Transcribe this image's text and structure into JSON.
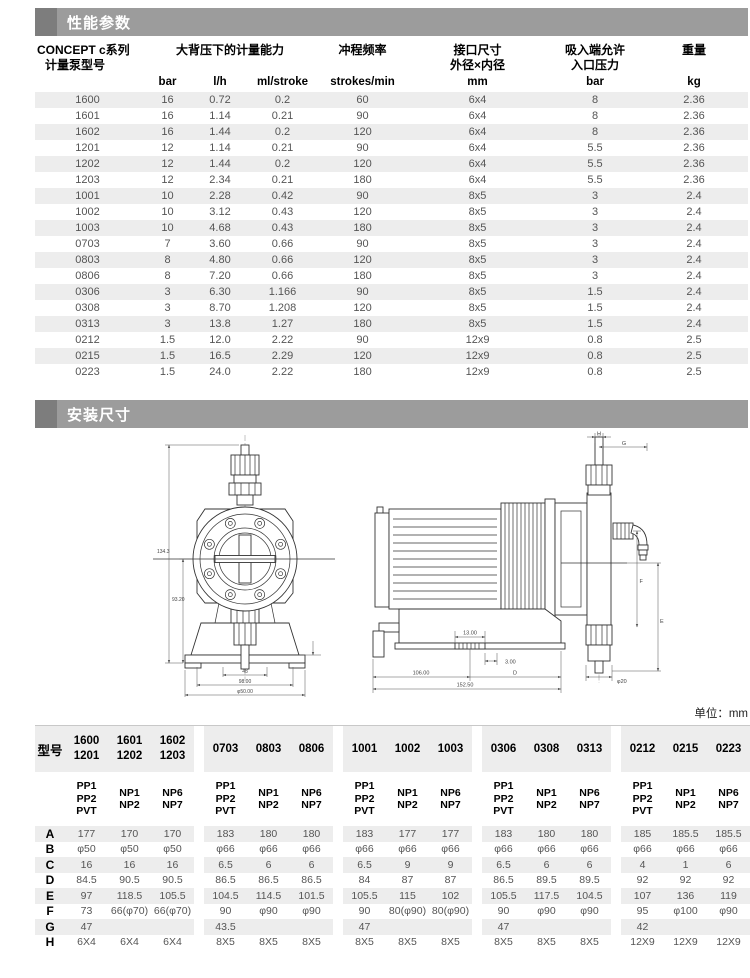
{
  "section1": {
    "title": "性能参数"
  },
  "perf_table": {
    "headers": {
      "model_line1": "CONCEPT c系列",
      "model_line2": "计量泵型号",
      "capacity": "大背压下的计量能力",
      "freq": "冲程频率",
      "port_line1": "接口尺寸",
      "port_line2": "外径×内径",
      "suction_line1": "吸入端允许",
      "suction_line2": "入口压力",
      "weight": "重量",
      "units": [
        "bar",
        "l/h",
        "ml/stroke",
        "strokes/min",
        "mm",
        "bar",
        "kg"
      ]
    },
    "rows": [
      [
        "1600",
        "16",
        "0.72",
        "0.2",
        "60",
        "6x4",
        "8",
        "2.36"
      ],
      [
        "1601",
        "16",
        "1.14",
        "0.21",
        "90",
        "6x4",
        "8",
        "2.36"
      ],
      [
        "1602",
        "16",
        "1.44",
        "0.2",
        "120",
        "6x4",
        "8",
        "2.36"
      ],
      [
        "1201",
        "12",
        "1.14",
        "0.21",
        "90",
        "6x4",
        "5.5",
        "2.36"
      ],
      [
        "1202",
        "12",
        "1.44",
        "0.2",
        "120",
        "6x4",
        "5.5",
        "2.36"
      ],
      [
        "1203",
        "12",
        "2.34",
        "0.21",
        "180",
        "6x4",
        "5.5",
        "2.36"
      ],
      [
        "1001",
        "10",
        "2.28",
        "0.42",
        "90",
        "8x5",
        "3",
        "2.4"
      ],
      [
        "1002",
        "10",
        "3.12",
        "0.43",
        "120",
        "8x5",
        "3",
        "2.4"
      ],
      [
        "1003",
        "10",
        "4.68",
        "0.43",
        "180",
        "8x5",
        "3",
        "2.4"
      ],
      [
        "0703",
        "7",
        "3.60",
        "0.66",
        "90",
        "8x5",
        "3",
        "2.4"
      ],
      [
        "0803",
        "8",
        "4.80",
        "0.66",
        "120",
        "8x5",
        "3",
        "2.4"
      ],
      [
        "0806",
        "8",
        "7.20",
        "0.66",
        "180",
        "8x5",
        "3",
        "2.4"
      ],
      [
        "0306",
        "3",
        "6.30",
        "1.166",
        "90",
        "8x5",
        "1.5",
        "2.4"
      ],
      [
        "0308",
        "3",
        "8.70",
        "1.208",
        "120",
        "8x5",
        "1.5",
        "2.4"
      ],
      [
        "0313",
        "3",
        "13.8",
        "1.27",
        "180",
        "8x5",
        "1.5",
        "2.4"
      ],
      [
        "0212",
        "1.5",
        "12.0",
        "2.22",
        "90",
        "12x9",
        "0.8",
        "2.5"
      ],
      [
        "0215",
        "1.5",
        "16.5",
        "2.29",
        "120",
        "12x9",
        "0.8",
        "2.5"
      ],
      [
        "0223",
        "1.5",
        "24.0",
        "2.22",
        "180",
        "12x9",
        "0.8",
        "2.5"
      ]
    ]
  },
  "section2": {
    "title": "安装尺寸"
  },
  "drawings": {
    "front": {
      "dim_height": "134.3",
      "dim_height2": "93.20",
      "dim_w1": "48",
      "dim_w2": "98.00",
      "dim_w3": "φ50.00"
    },
    "side": {
      "h": "H",
      "g": "G",
      "f": "F",
      "e": "E",
      "d": "D",
      "phi20": "φ20",
      "dim1": "13.00",
      "dim2": "3.00",
      "dim3": "106.00",
      "dim4": "152.50"
    }
  },
  "unit_note": "单位：mm",
  "dim_table": {
    "corner": "型号",
    "models": [
      [
        "1600",
        "1201"
      ],
      [
        "1601",
        "1202"
      ],
      [
        "1602",
        "1203"
      ],
      [
        "0703"
      ],
      [
        "0803"
      ],
      [
        "0806"
      ],
      [
        "1001"
      ],
      [
        "1002"
      ],
      [
        "1003"
      ],
      [
        "0306"
      ],
      [
        "0308"
      ],
      [
        "0313"
      ],
      [
        "0212"
      ],
      [
        "0215"
      ],
      [
        "0223"
      ]
    ],
    "materials": [
      [
        "PP1",
        "PP2",
        "PVT"
      ],
      [
        "NP1",
        "NP2"
      ],
      [
        "NP6",
        "NP7"
      ],
      [
        "PP1",
        "PP2",
        "PVT"
      ],
      [
        "NP1",
        "NP2"
      ],
      [
        "NP6",
        "NP7"
      ],
      [
        "PP1",
        "PP2",
        "PVT"
      ],
      [
        "NP1",
        "NP2"
      ],
      [
        "NP6",
        "NP7"
      ],
      [
        "PP1",
        "PP2",
        "PVT"
      ],
      [
        "NP1",
        "NP2"
      ],
      [
        "NP6",
        "NP7"
      ],
      [
        "PP1",
        "PP2",
        "PVT"
      ],
      [
        "NP1",
        "NP2"
      ],
      [
        "NP6",
        "NP7"
      ]
    ],
    "rows": [
      {
        "label": "A",
        "values": [
          "177",
          "170",
          "170",
          "183",
          "180",
          "180",
          "183",
          "177",
          "177",
          "183",
          "180",
          "180",
          "185",
          "185.5",
          "185.5"
        ]
      },
      {
        "label": "B",
        "values": [
          "φ50",
          "φ50",
          "φ50",
          "φ66",
          "φ66",
          "φ66",
          "φ66",
          "φ66",
          "φ66",
          "φ66",
          "φ66",
          "φ66",
          "φ66",
          "φ66",
          "φ66"
        ]
      },
      {
        "label": "C",
        "values": [
          "16",
          "16",
          "16",
          "6.5",
          "6",
          "6",
          "6.5",
          "9",
          "9",
          "6.5",
          "6",
          "6",
          "4",
          "1",
          "6"
        ]
      },
      {
        "label": "D",
        "values": [
          "84.5",
          "90.5",
          "90.5",
          "86.5",
          "86.5",
          "86.5",
          "84",
          "87",
          "87",
          "86.5",
          "89.5",
          "89.5",
          "92",
          "92",
          "92"
        ]
      },
      {
        "label": "E",
        "values": [
          "97",
          "118.5",
          "105.5",
          "104.5",
          "114.5",
          "101.5",
          "105.5",
          "115",
          "102",
          "105.5",
          "117.5",
          "104.5",
          "107",
          "136",
          "119"
        ]
      },
      {
        "label": "F",
        "values": [
          "73",
          "66(φ70)",
          "66(φ70)",
          "90",
          "φ90",
          "φ90",
          "90",
          "80(φ90)",
          "80(φ90)",
          "90",
          "φ90",
          "φ90",
          "95",
          "φ100",
          "φ90"
        ]
      },
      {
        "label": "G",
        "values": [
          "47",
          "",
          "",
          "43.5",
          "",
          "",
          "47",
          "",
          "",
          "47",
          "",
          "",
          "42",
          "",
          ""
        ]
      },
      {
        "label": "H",
        "values": [
          "6X4",
          "6X4",
          "6X4",
          "8X5",
          "8X5",
          "8X5",
          "8X5",
          "8X5",
          "8X5",
          "8X5",
          "8X5",
          "8X5",
          "12X9",
          "12X9",
          "12X9"
        ]
      }
    ]
  }
}
